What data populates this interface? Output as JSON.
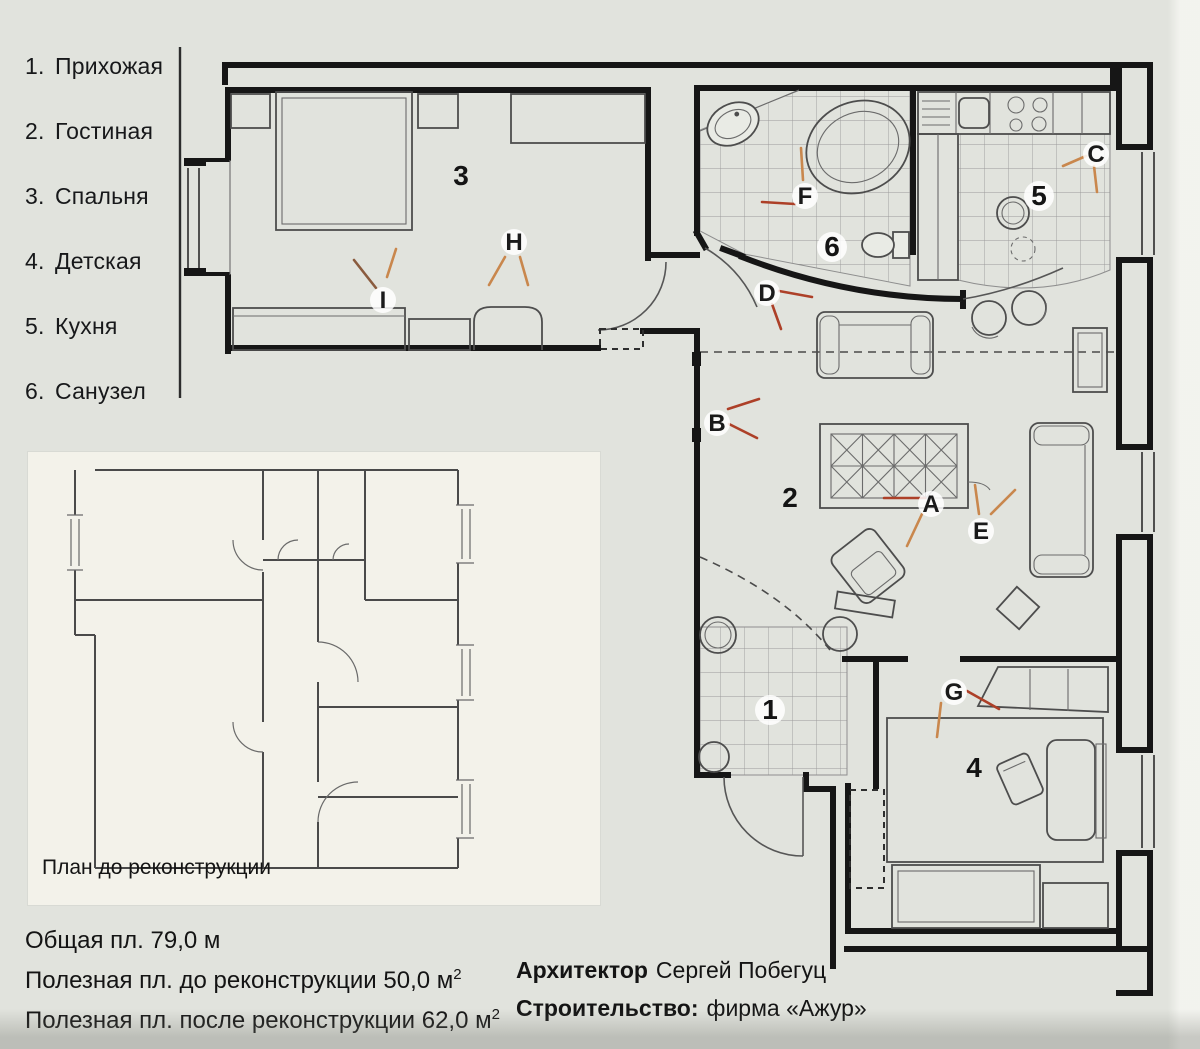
{
  "legend": {
    "items": [
      {
        "num": "1.",
        "label": "Прихожая"
      },
      {
        "num": "2.",
        "label": "Гостиная"
      },
      {
        "num": "3.",
        "label": "Спальня"
      },
      {
        "num": "4.",
        "label": "Детская"
      },
      {
        "num": "5.",
        "label": "Кухня"
      },
      {
        "num": "6.",
        "label": "Санузел"
      }
    ]
  },
  "plan": {
    "room_numbers": [
      "1",
      "2",
      "3",
      "4",
      "5",
      "6"
    ],
    "callout_letters": [
      "A",
      "B",
      "C",
      "D",
      "E",
      "F",
      "G",
      "H",
      "I"
    ]
  },
  "inset": {
    "caption": "План до реконструкции"
  },
  "footer": {
    "area_total": "Общая пл. 79,0 м",
    "area_before": "Полезная пл. до реконструкции 50,0 м",
    "area_before_sup": "2",
    "area_after": "Полезная пл. после реконструкции 62,0 м",
    "area_after_sup": "2"
  },
  "credits": {
    "architect_label": "Архитектор",
    "architect_name": "Сергей Побегуц",
    "builder_label": "Строительство:",
    "builder_name": "фирма «Ажур»"
  },
  "colors": {
    "paper": "#e1e3dd",
    "panel": "#f3f2ea",
    "ink": "#161616",
    "leader_red": "#ad4028",
    "leader_orange": "#c9874d"
  }
}
